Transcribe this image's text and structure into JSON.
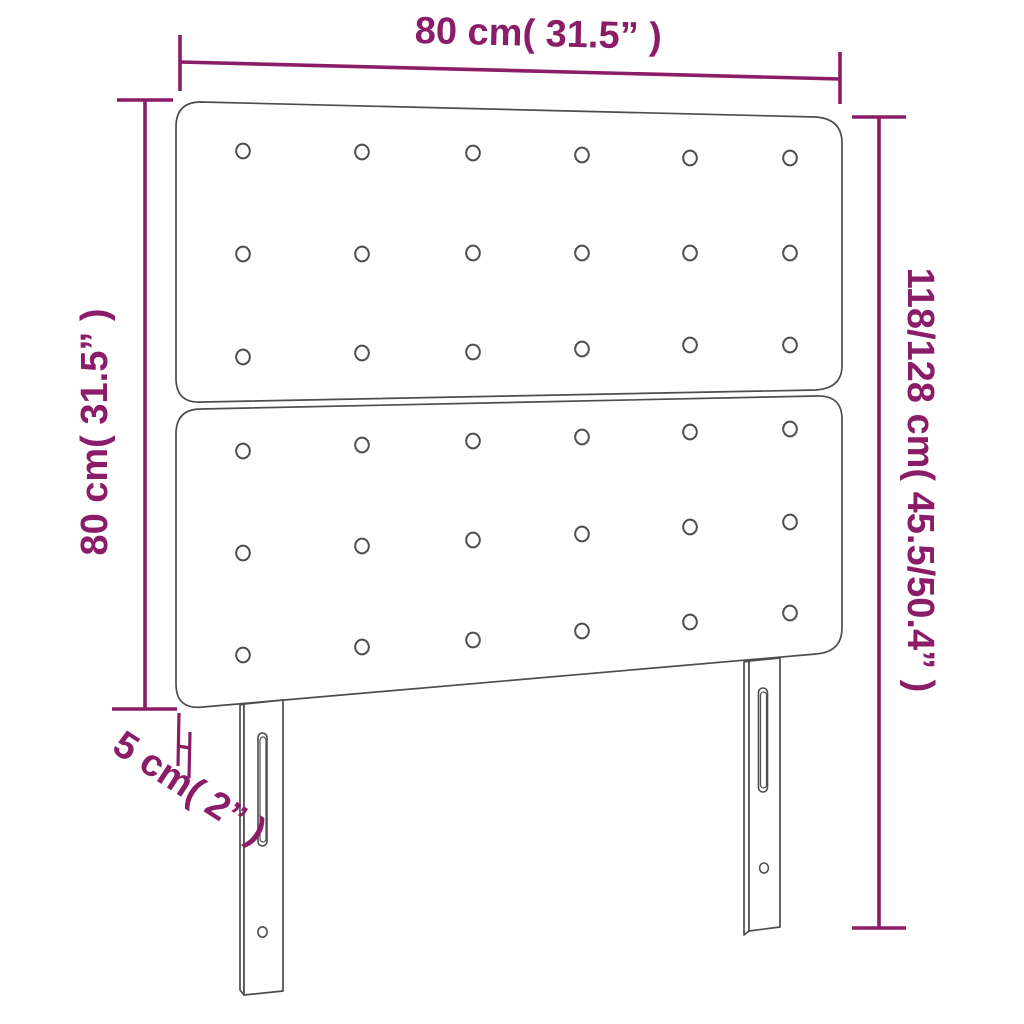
{
  "diagram": {
    "type": "product-dimension-diagram",
    "subject": "tufted headboard with two slotted adjustable legs",
    "accent_color": "#8a1c68",
    "line_color": "#4d4d4d",
    "dimensions": {
      "width_top": "80 cm( 31.5” )",
      "height_left": "80 cm( 31.5” )",
      "height_right": "118/128 cm( 45.5/50.4” )",
      "depth": "5 cm( 2” )"
    },
    "tufting": {
      "panels": 2,
      "rows_per_panel": 3,
      "columns": 6
    }
  }
}
